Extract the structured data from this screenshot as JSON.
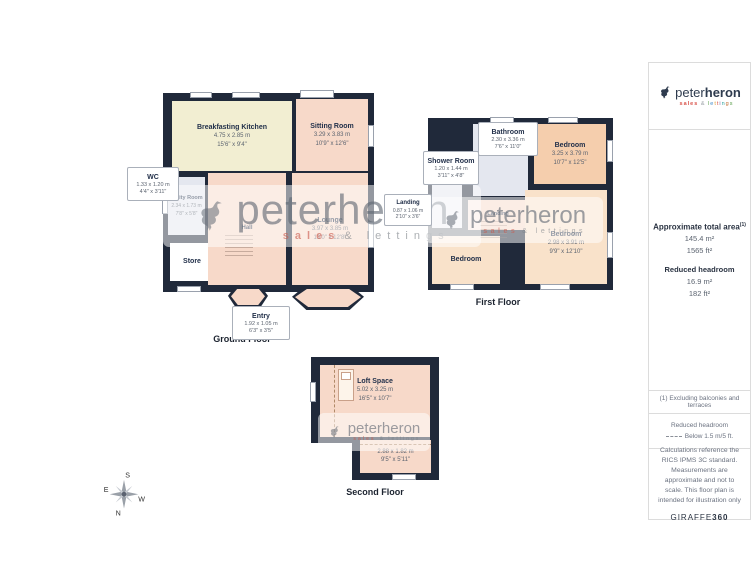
{
  "brand": {
    "name_light": "peter",
    "name_bold": "heron",
    "tagline_sales": "sales",
    "tagline_amp": "&",
    "tagline_lettings": "lettings"
  },
  "watermark": {
    "text": "peterheron",
    "tagline_sales": "sales",
    "tagline_rest": "& lettings"
  },
  "floors": {
    "ground": {
      "label": "Ground Floor",
      "rooms": {
        "kitchen": {
          "name": "Breakfasting Kitchen",
          "m": "4.75 x 2.85 m",
          "ft": "15'6\" x 9'4\""
        },
        "sitting": {
          "name": "Sitting Room",
          "m": "3.29 x 3.83 m",
          "ft": "10'9\" x 12'6\""
        },
        "wc": {
          "name": "WC",
          "m": "1.33 x 1.20 m",
          "ft": "4'4\" x 3'11\""
        },
        "utility": {
          "name": "Utility Room",
          "m": "2.34 x 1.73 m",
          "ft": "7'8\" x 5'8\""
        },
        "store": {
          "name": "Store"
        },
        "hall": {
          "name": "Hall"
        },
        "lounge": {
          "name": "Lounge",
          "m": "3.97 x 3.85 m",
          "ft": "13'0\" x 12'8\""
        },
        "entry": {
          "name": "Entry",
          "m": "1.92 x 1.05 m",
          "ft": "6'3\" x 3'5\""
        }
      }
    },
    "first": {
      "label": "First Floor",
      "rooms": {
        "bathroom": {
          "name": "Bathroom",
          "m": "2.30 x 3.36 m",
          "ft": "7'6\" x 11'0\""
        },
        "shower": {
          "name": "Shower Room",
          "m": "1.20 x 1.44 m",
          "ft": "3'11\" x 4'8\""
        },
        "landing_callout": {
          "name": "Landing",
          "m": "0.87 x 1.06 m",
          "ft": "2'10\" x 3'6\""
        },
        "landing": {
          "name": "Landing"
        },
        "bedroom_right": {
          "name": "Bedroom",
          "m": "3.25 x 3.79 m",
          "ft": "10'7\" x 12'5\""
        },
        "bedroom_bottom": {
          "name": "Bedroom",
          "m": "2.98 x 3.91 m",
          "ft": "9'9\" x 12'10\""
        },
        "bedroom_left": {
          "name": "Bedroom"
        }
      }
    },
    "second": {
      "label": "Second Floor",
      "rooms": {
        "loft": {
          "name": "Loft Space",
          "m": "5.02 x 3.25 m",
          "ft": "16'5\" x 10'7\""
        },
        "eaves": {
          "m": "2.88 x 1.82 m",
          "ft": "9'5\" x 5'11\""
        }
      }
    }
  },
  "sidebar": {
    "area": {
      "title": "Approximate total area",
      "footnote_marker": "(1)",
      "total_m2": "145.4 m²",
      "total_ft2": "1565 ft²",
      "reduced_title": "Reduced headroom",
      "reduced_m2": "16.9 m²",
      "reduced_ft2": "182 ft²"
    },
    "footnote": "(1) Excluding balconies and terraces",
    "legend": {
      "title": "Reduced headroom",
      "item": "Below 1.5 m/5 ft."
    },
    "disclaimer": "Calculations reference the RICS IPMS 3C standard. Measurements are approximate and not to scale. This floor plan is intended for illustration only",
    "credit_name": "GIRAFFE",
    "credit_num": "360"
  },
  "compass": {
    "n": "N",
    "s": "S",
    "e": "E",
    "w": "W"
  }
}
